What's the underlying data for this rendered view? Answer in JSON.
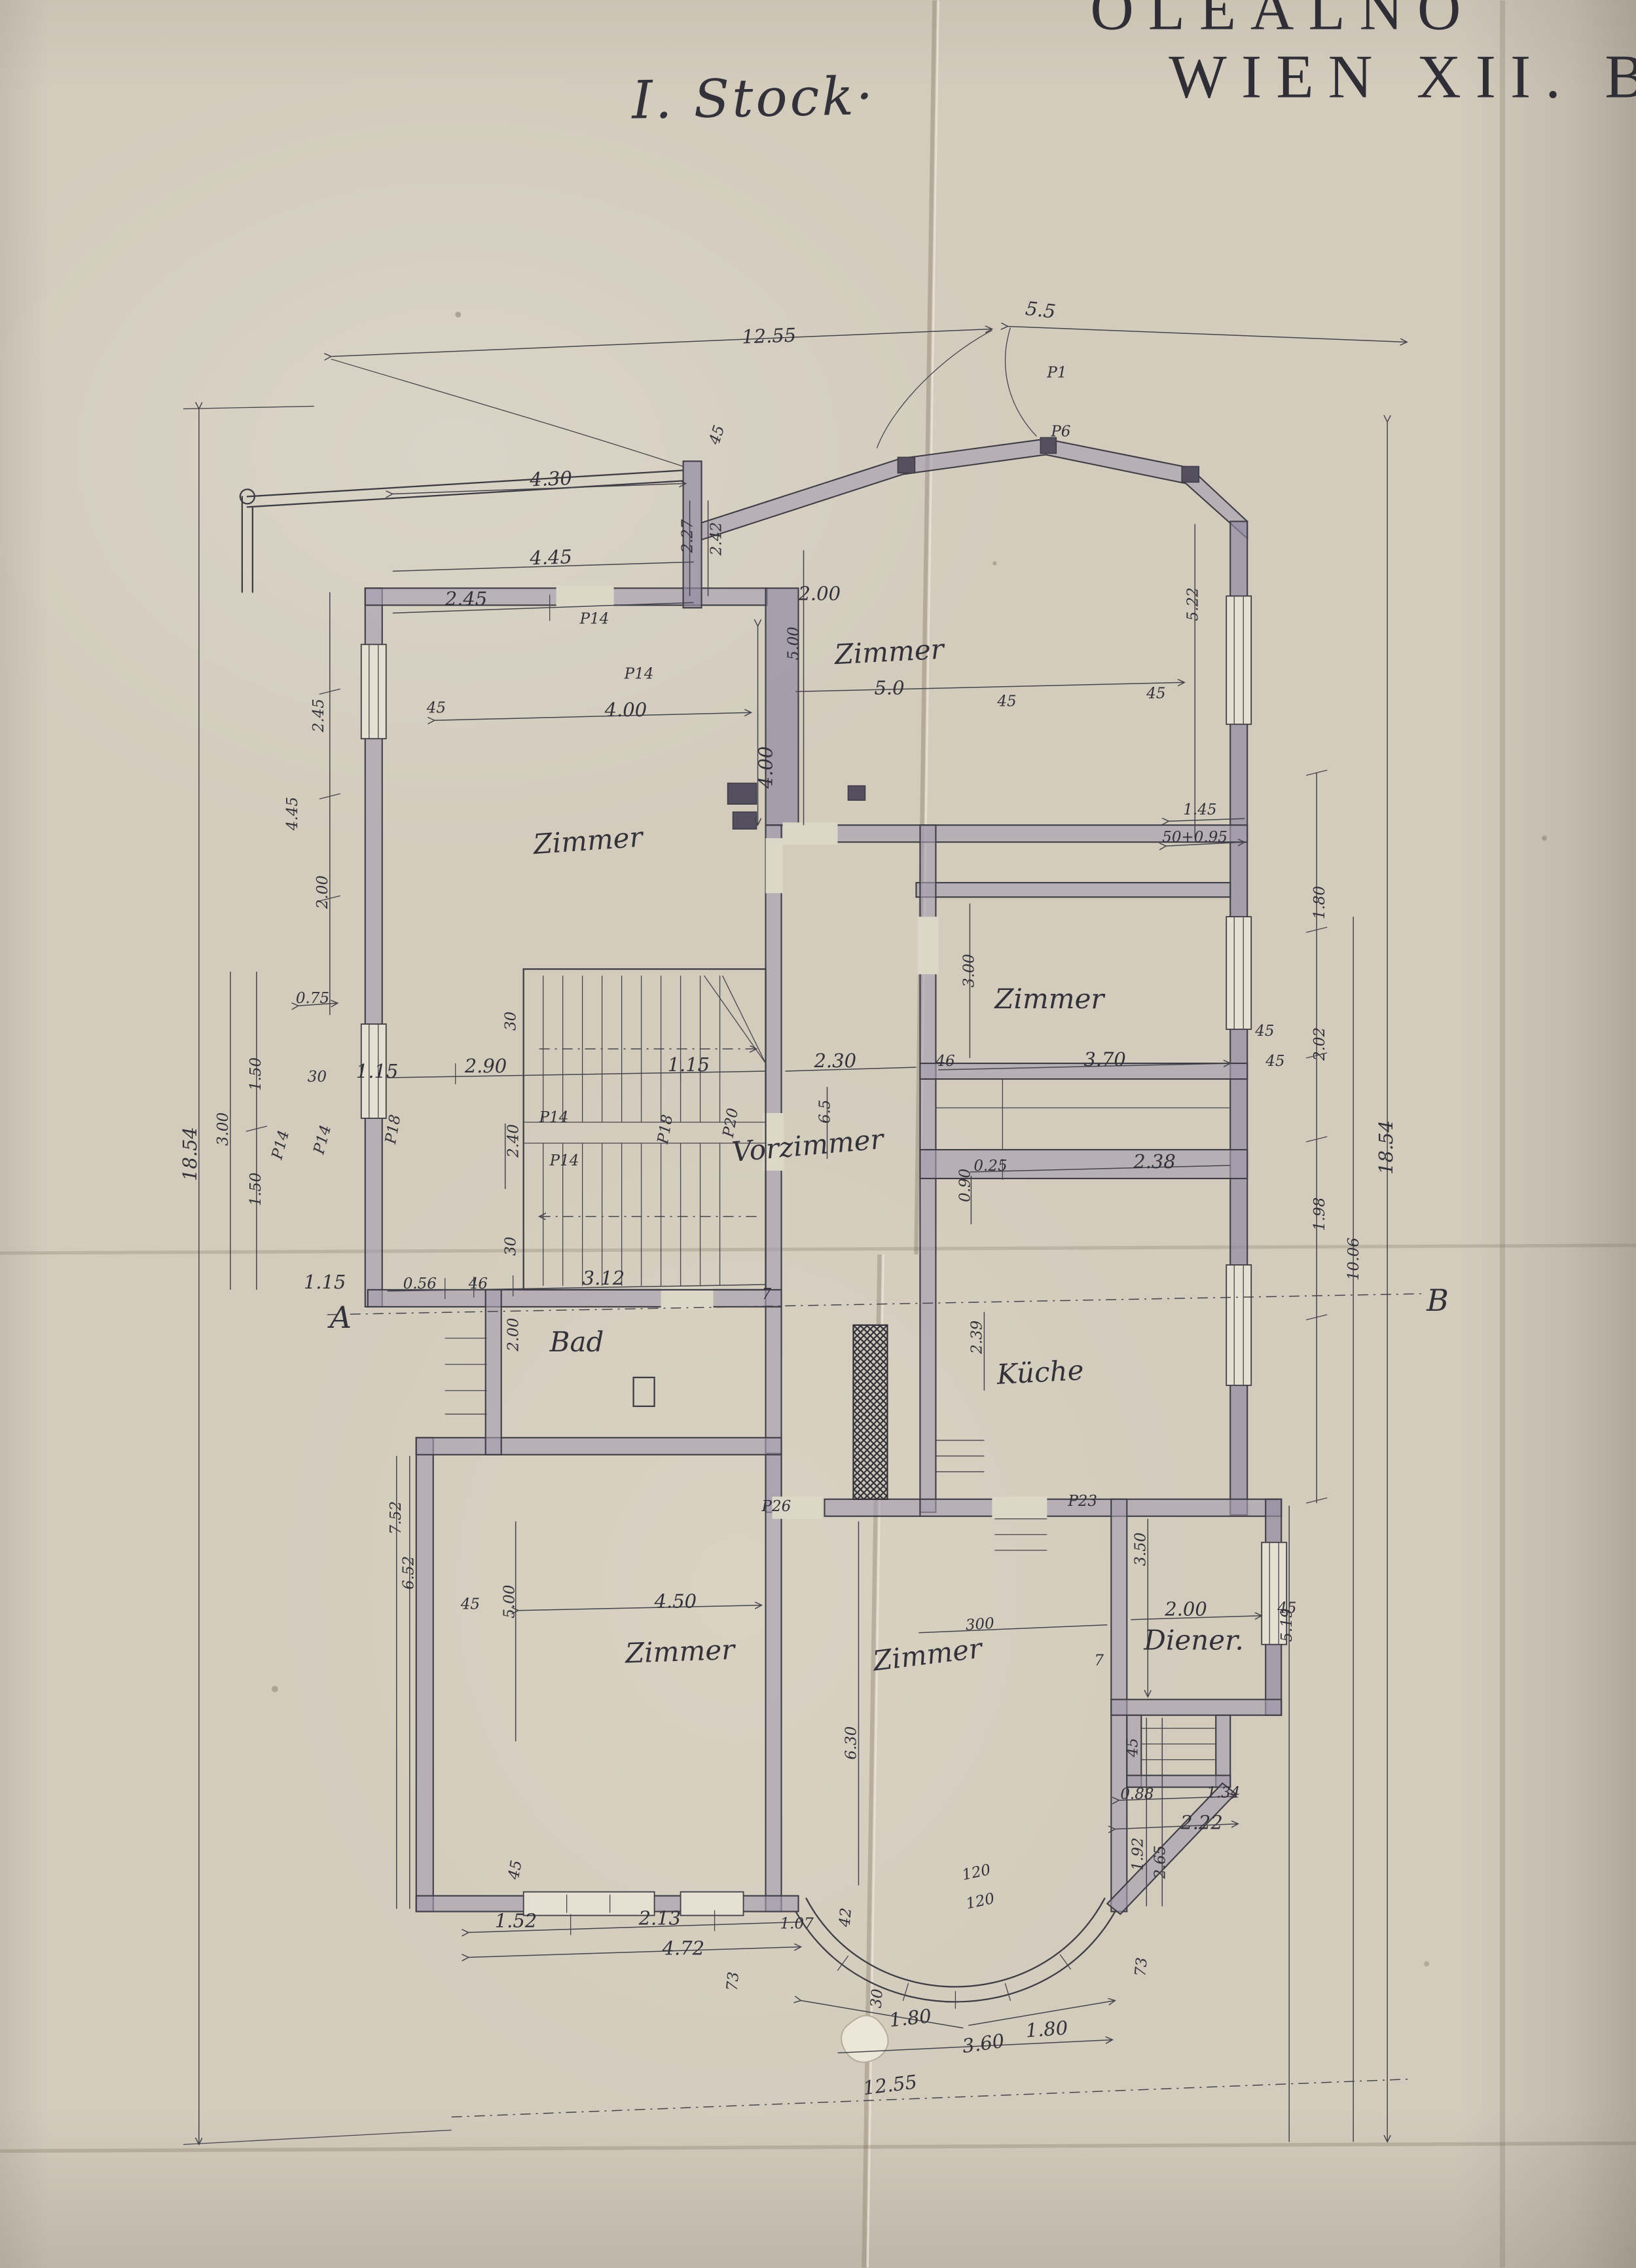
{
  "colors": {
    "paper": "#d3ccbd",
    "ink": "#3e3d45",
    "wall_fill": "#a59dae",
    "wall_dark": "#8f87a0"
  },
  "header": {
    "project_line1": "OLEALNO",
    "project_line2": "WIEN XII. BE",
    "floor_title": "I. Stock·"
  },
  "rooms": {
    "zimmer": "Zimmer",
    "zimmer_ne_size": "5.0",
    "vorzimmer": "Vorzimmer",
    "bad": "Bad",
    "kueche": "Küche",
    "diener": "Diener."
  },
  "doors": {
    "p1": "P1",
    "p6": "P6",
    "p14": "P14",
    "p18": "P18",
    "p20": "P20",
    "p23": "P23",
    "p26": "P26"
  },
  "sections": {
    "a": "A",
    "b": "B"
  },
  "dims": {
    "d1255": "12.55",
    "d55": "5.5",
    "d430": "4.30",
    "d227": "2.27",
    "d242": "2.42",
    "d445": "4.45",
    "d245": "2.45",
    "d200": "2.00",
    "d400": "4.00",
    "d075": "0.75",
    "d500": "5.00",
    "d522": "5.22",
    "d145": "1.45",
    "d5095": "50+0.95",
    "d180": "1.80",
    "d202": "2.02",
    "d198": "1.98",
    "d1006": "10.06",
    "d1854": "18.54",
    "d519": "5.19",
    "d115": "1.15",
    "d290": "2.90",
    "d240": "2.40",
    "d150": "1.50",
    "d300": "3.00",
    "d230": "2.30",
    "d370": "3.70",
    "d025": "0.25",
    "d238": "2.38",
    "d090": "0.90",
    "d239": "2.39",
    "d056": "0.56",
    "d312": "3.12",
    "d450": "4.50",
    "d752": "7.52",
    "d652": "6.52",
    "d300s": "300",
    "d630": "6.30",
    "d350": "3.50",
    "d088": "0.88",
    "d134": "1.34",
    "d222": "2.22",
    "d192": "1.92",
    "d265": "2.65",
    "d152": "1.52",
    "d213": "2.13",
    "d107": "1.07",
    "d472": "4.72",
    "d360": "3.60",
    "d120": "120",
    "d65": "6.5",
    "w45": "45",
    "w46": "46",
    "w30": "30",
    "w73": "73",
    "w42": "42",
    "w7": "7"
  }
}
